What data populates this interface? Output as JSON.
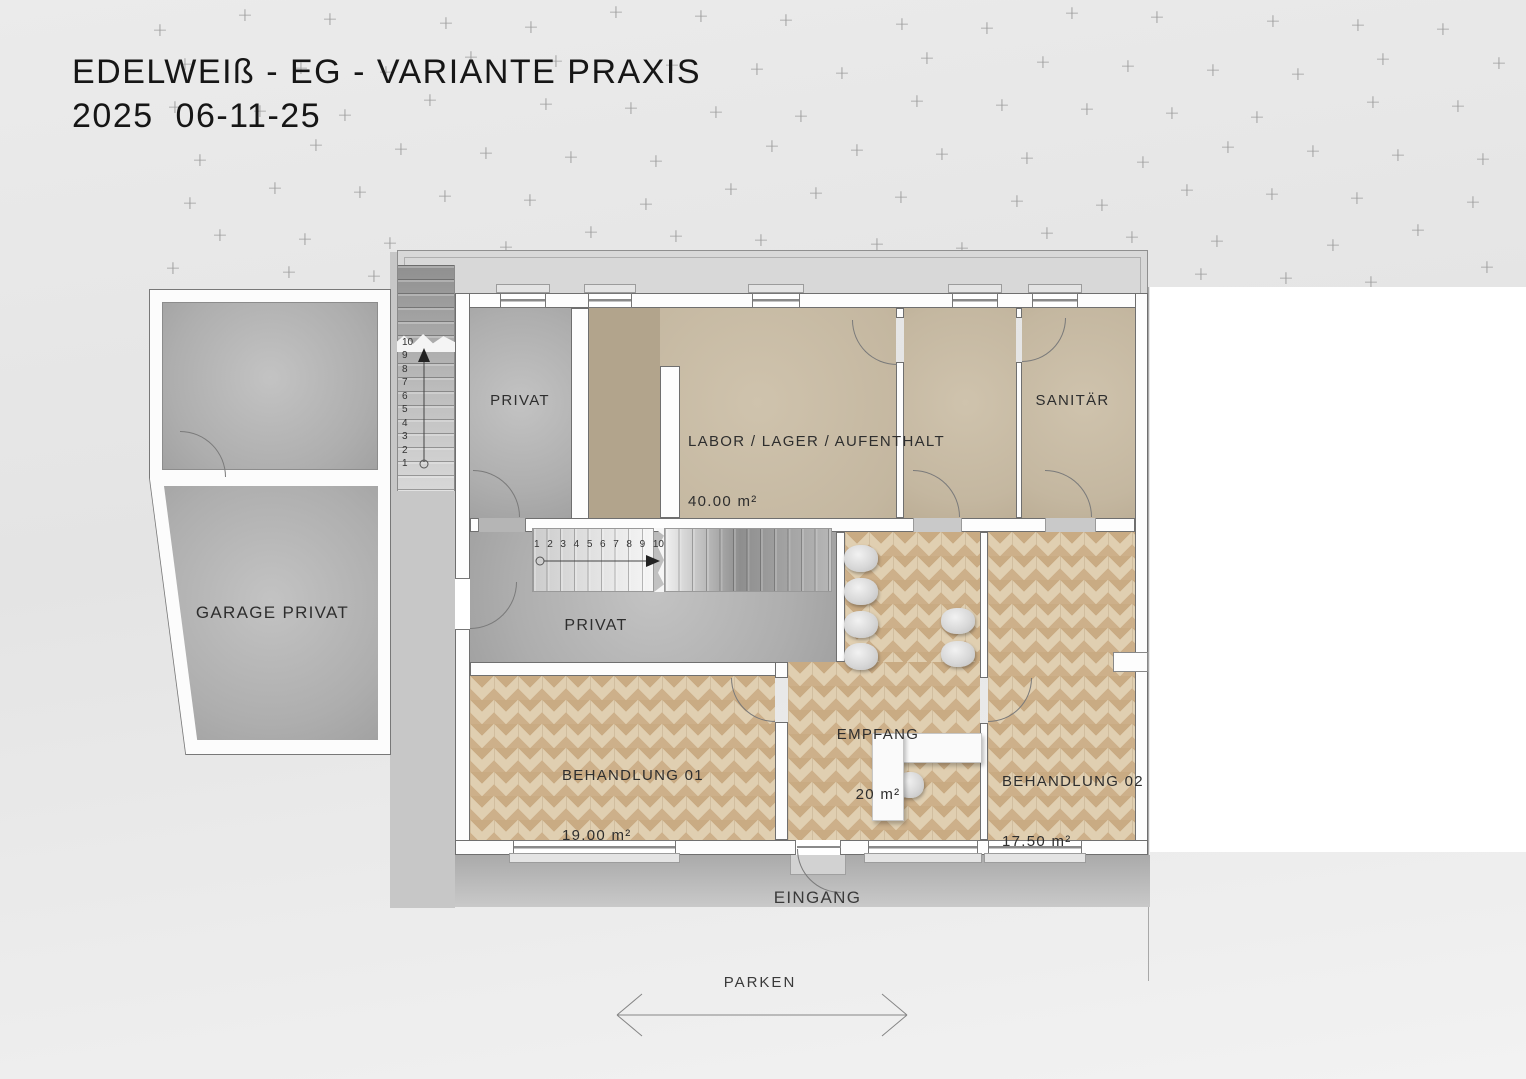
{
  "title": {
    "line1": "EDELWEIß - EG - VARIANTE PRAXIS",
    "line2": "2025  06-11-25"
  },
  "site": {
    "parken_label": "PARKEN",
    "eingang_label": "EINGANG"
  },
  "rooms": {
    "privat_top": {
      "label": "PRIVAT"
    },
    "labor": {
      "label": "LABOR / LAGER / AUFENTHALT",
      "area": "40.00 m²"
    },
    "sanitaer": {
      "label": "SANITÄR"
    },
    "flur": {
      "label": "PRIVAT"
    },
    "garage": {
      "label": "GARAGE PRIVAT"
    },
    "empfang": {
      "label": "EMPFANG",
      "area": "20 m²"
    },
    "behandlung01": {
      "label": "BEHANDLUNG 01",
      "area": "19.00 m²"
    },
    "behandlung02": {
      "label": "BEHANDLUNG 02",
      "area": "17.50 m²"
    }
  },
  "stairs": {
    "exterior_numbers": [
      "10",
      "9",
      "8",
      "7",
      "6",
      "5",
      "4",
      "3",
      "2",
      "1"
    ],
    "interior_numbers": [
      "1",
      "2",
      "3",
      "4",
      "5",
      "6",
      "7",
      "8",
      "9",
      "10"
    ]
  },
  "decor": {
    "marker_symbol": "+"
  },
  "colors": {
    "parquet_base": "#e0cfb1",
    "parquet_chevron": "#c9ab83",
    "floor_gray": "#aeaeae",
    "floor_beige": "#c4b7a0",
    "wall_outline": "#6f6f6f",
    "marker": "#9c9c9c"
  }
}
